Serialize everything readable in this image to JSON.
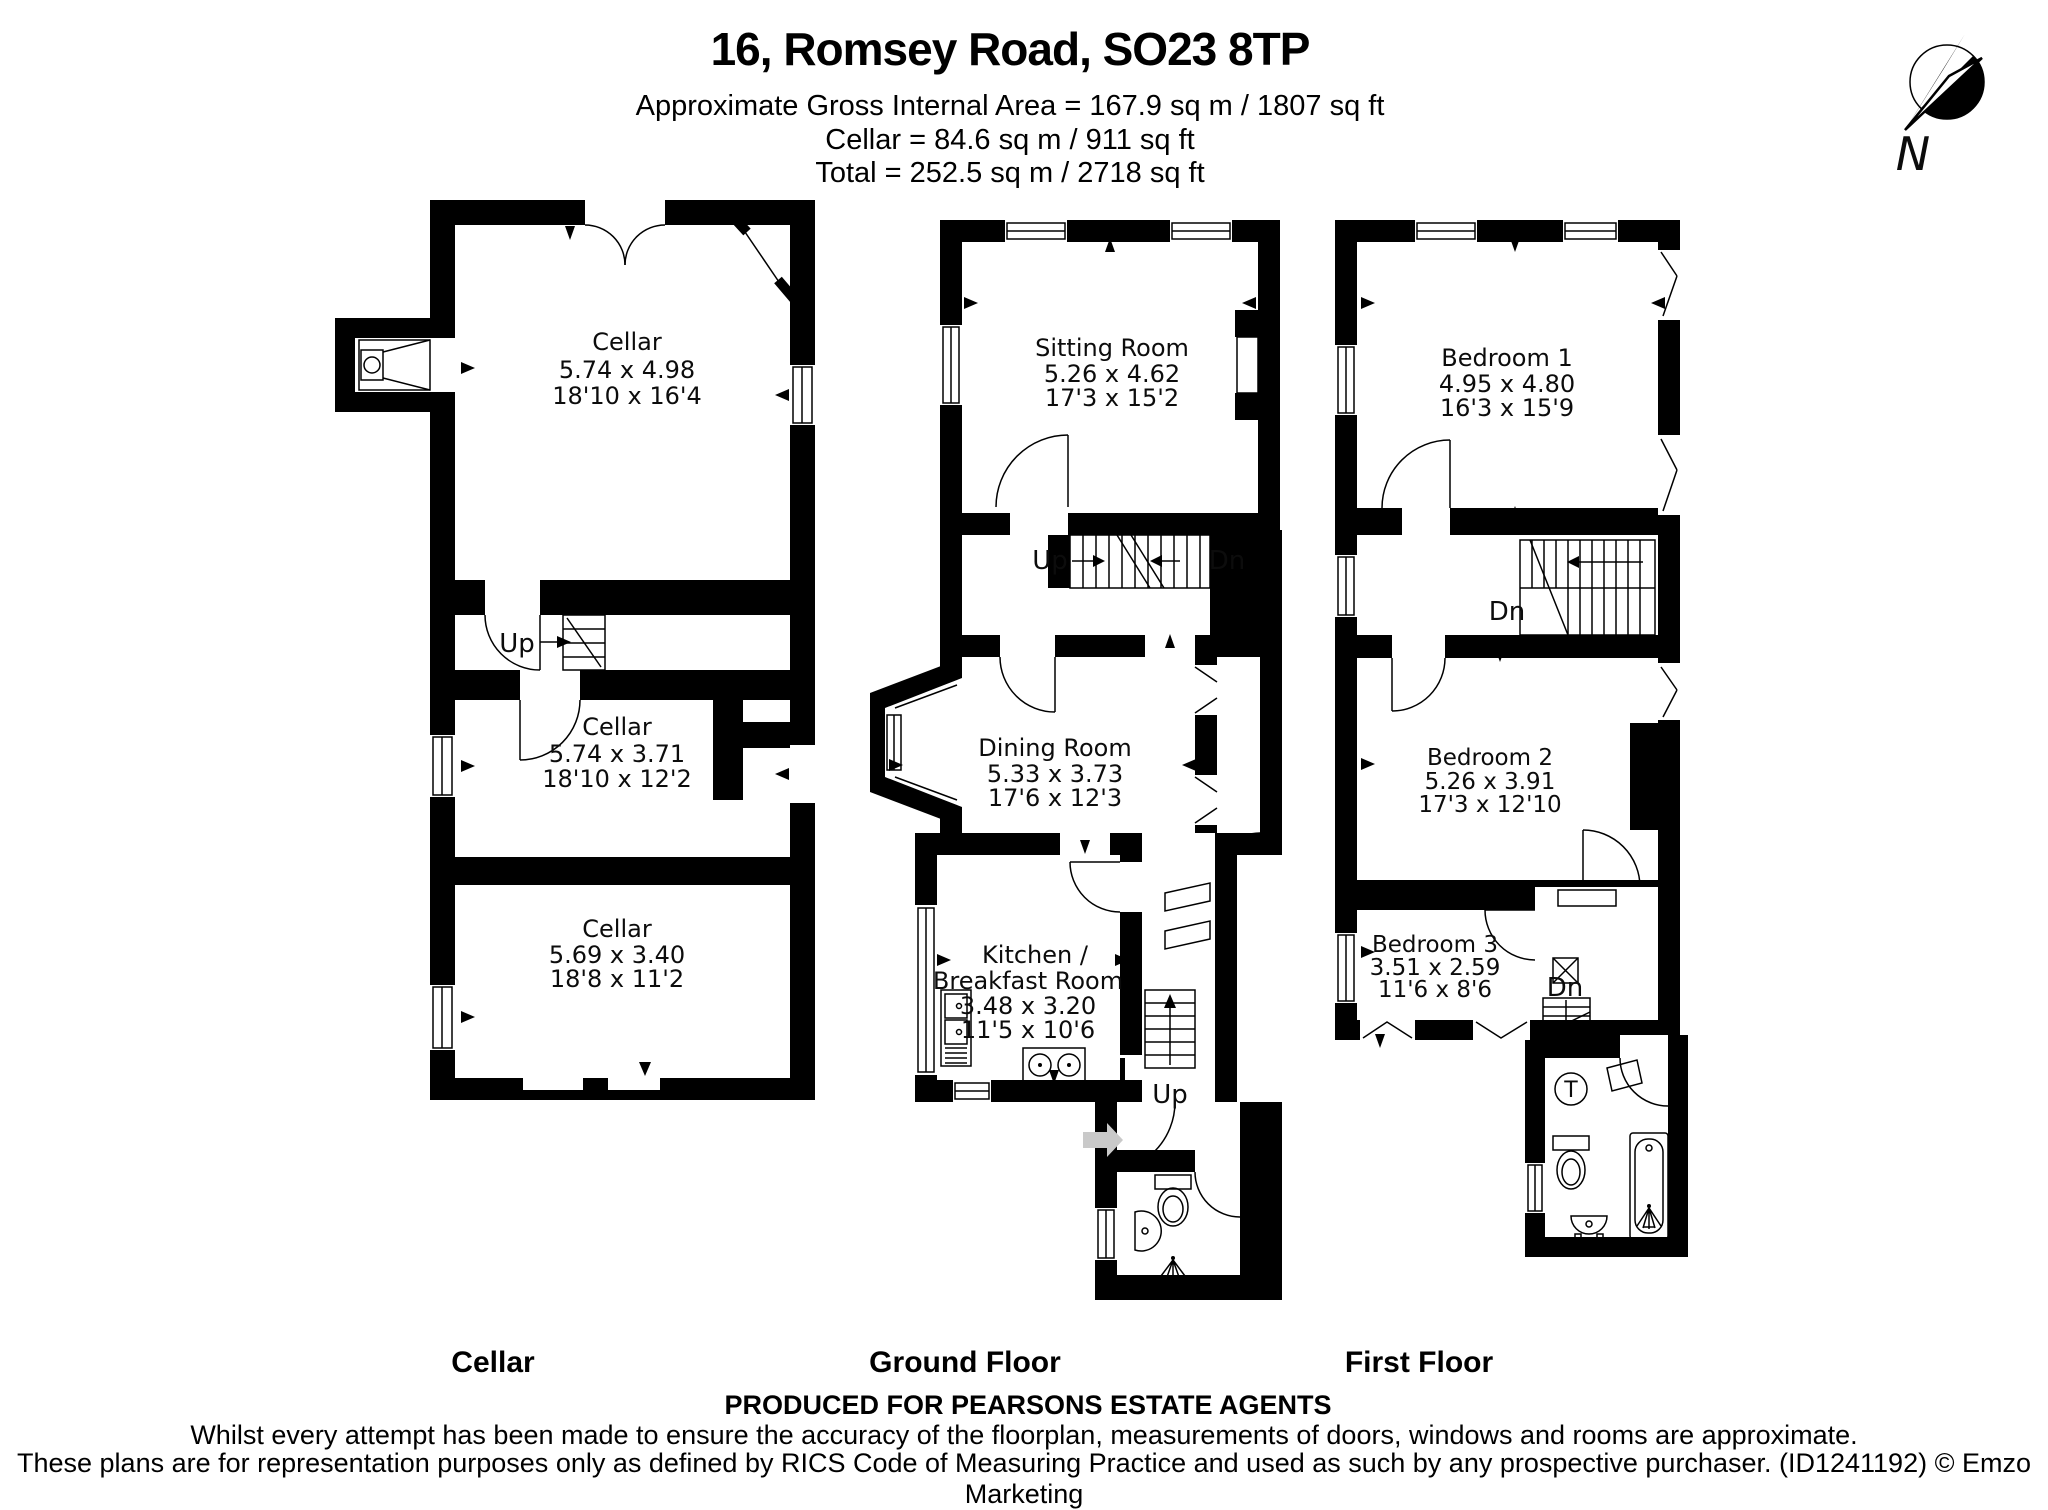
{
  "header": {
    "title": "16, Romsey Road, SO23 8TP",
    "subtitle1": "Approximate Gross Internal Area = 167.9 sq m / 1807 sq ft",
    "subtitle2": "Cellar = 84.6 sq m / 911 sq ft",
    "subtitle3": "Total = 252.5 sq m / 2718 sq ft"
  },
  "compass": {
    "north_label": "N"
  },
  "cellar": {
    "floor_label": "Cellar",
    "room1": {
      "name": "Cellar",
      "metric": "5.74 x 4.98",
      "imperial": "18'10 x 16'4"
    },
    "room2": {
      "name": "Cellar",
      "metric": "5.74 x 3.71",
      "imperial": "18'10 x 12'2"
    },
    "room3": {
      "name": "Cellar",
      "metric": "5.69 x 3.40",
      "imperial": "18'8 x 11'2"
    },
    "stairs_up": "Up"
  },
  "ground": {
    "floor_label": "Ground Floor",
    "sitting": {
      "name": "Sitting Room",
      "metric": "5.26 x 4.62",
      "imperial": "17'3 x 15'2"
    },
    "dining": {
      "name": "Dining Room",
      "metric": "5.33 x 3.73",
      "imperial": "17'6 x 12'3"
    },
    "kitchen": {
      "name1": "Kitchen /",
      "name2": "Breakfast Room",
      "metric": "3.48 x 3.20",
      "imperial": "11'5 x 10'6"
    },
    "stairs_up": "Up",
    "stairs_dn": "Dn",
    "stairs_up2": "Up"
  },
  "first": {
    "floor_label": "First Floor",
    "bed1": {
      "name": "Bedroom 1",
      "metric": "4.95 x 4.80",
      "imperial": "16'3 x 15'9"
    },
    "bed2": {
      "name": "Bedroom 2",
      "metric": "5.26 x 3.91",
      "imperial": "17'3 x 12'10"
    },
    "bed3": {
      "name": "Bedroom 3",
      "metric": "3.51 x 2.59",
      "imperial": "11'6 x 8'6"
    },
    "stairs_dn": "Dn",
    "stairs_dn2": "Dn",
    "tank_label": "T"
  },
  "footer": {
    "produced": "PRODUCED FOR PEARSONS ESTATE AGENTS",
    "disclaimer1": "Whilst every attempt has been made to ensure the accuracy of the floorplan, measurements of doors, windows and rooms are approximate.",
    "disclaimer2": "These plans are for representation purposes only as defined by RICS Code of Measuring Practice and used as such by any prospective purchaser. (ID1241192) © Emzo Marketing"
  }
}
